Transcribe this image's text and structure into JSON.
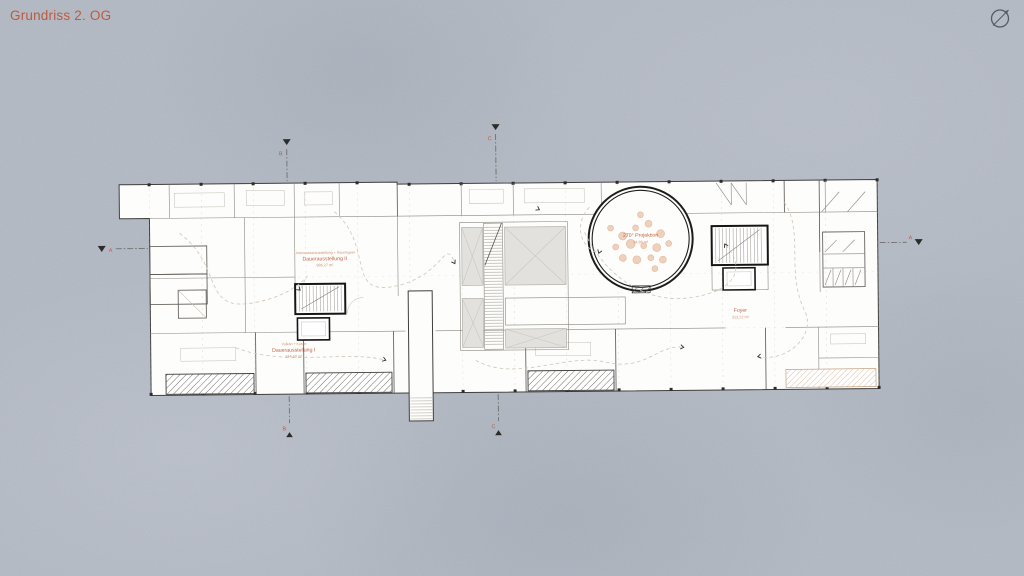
{
  "page": {
    "title": "Grundriss 2. OG"
  },
  "colors": {
    "accent": "#bd5a40",
    "background": "#b8bec8",
    "label_strong": "#c26243",
    "label_soft": "#cf9070",
    "plan_paper": "#fdfdfb"
  },
  "icons": {
    "north_arrow": "compass-north-arrow"
  },
  "plan": {
    "rooms": [
      {
        "id": "dauerausstellung-ii",
        "category": "Unterwasserausstellung + Raumtypen",
        "name": "Dauerausstellung II",
        "area": "986.27 m²"
      },
      {
        "id": "dauerausstellung-i",
        "category": "Vulkan + Küste",
        "name": "Dauerausstellung I",
        "area": "244.60 m²"
      },
      {
        "id": "projektion-270",
        "category": "",
        "name": "270° Projektion",
        "area": "94.86 m²"
      },
      {
        "id": "foyer",
        "category": "",
        "name": "Foyer",
        "area": "313.22 m²"
      }
    ],
    "section_markers": {
      "a_left": "A",
      "a_right": "A",
      "b_top": "B",
      "b_bottom": "B",
      "c_top": "C",
      "c_bottom": "C"
    }
  }
}
